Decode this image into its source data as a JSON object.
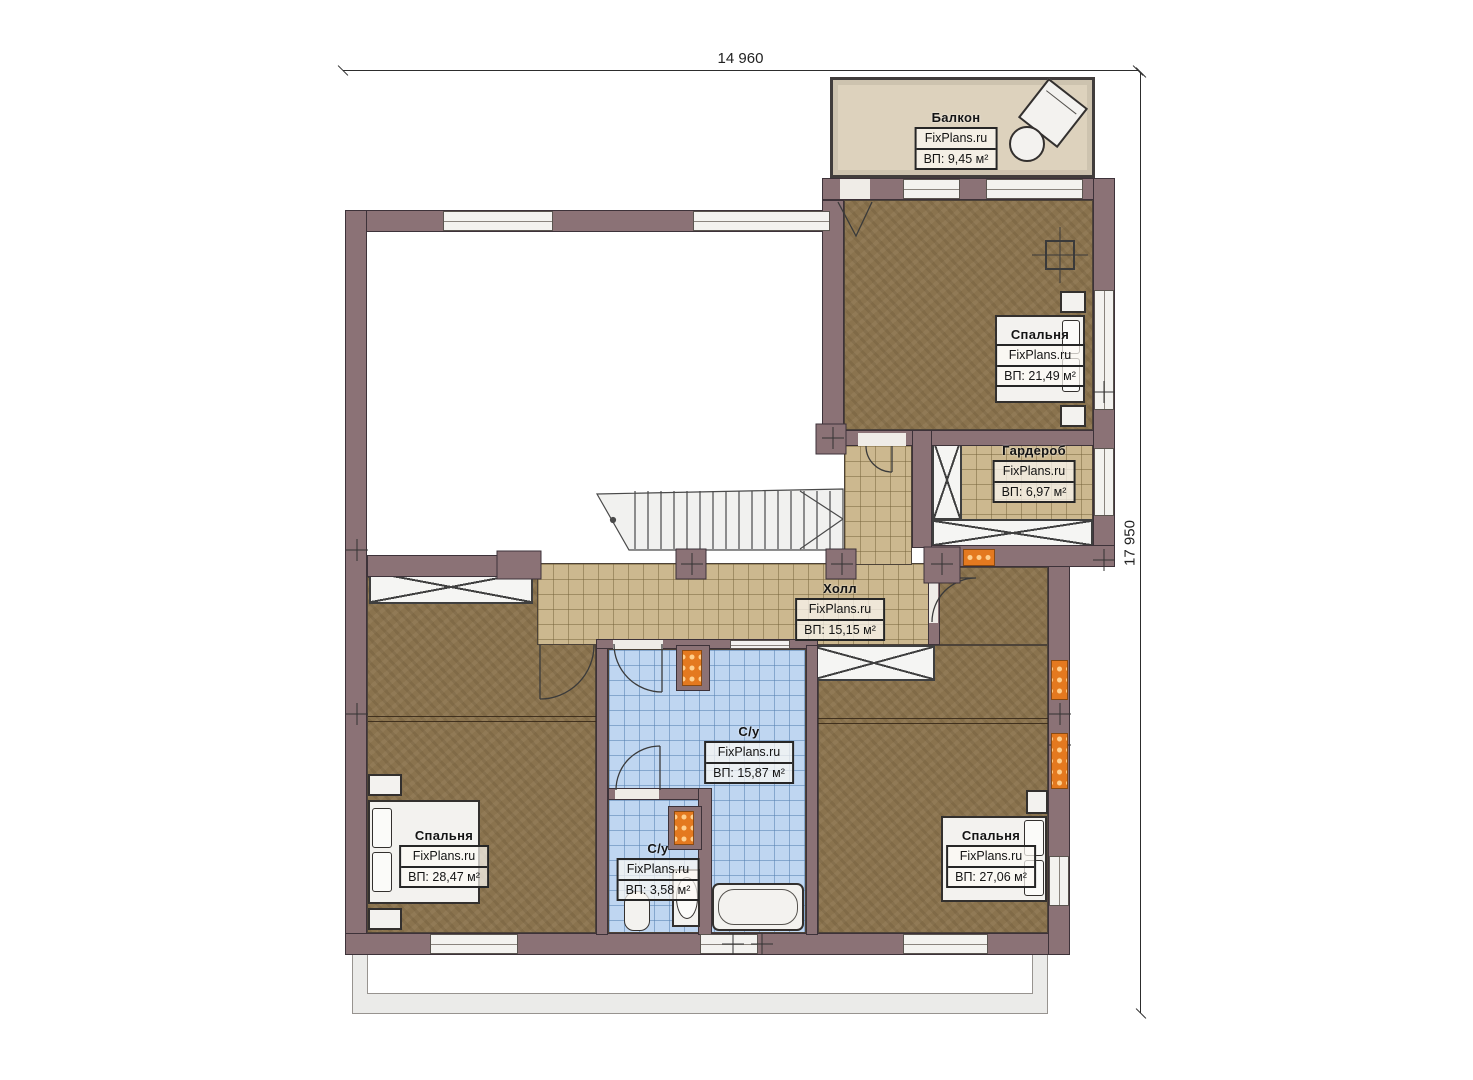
{
  "dimensions": {
    "top": "14 960",
    "right": "17 950"
  },
  "rooms": {
    "balcony": {
      "name": "Балкон",
      "brand": "FixPlans.ru",
      "area": "ВП: 9,45 м²"
    },
    "bedroom_tr": {
      "name": "Спальня",
      "brand": "FixPlans.ru",
      "area": "ВП: 21,49 м²"
    },
    "wardrobe": {
      "name": "Гардероб",
      "brand": "FixPlans.ru",
      "area": "ВП: 6,97 м²"
    },
    "hall": {
      "name": "Холл",
      "brand": "FixPlans.ru",
      "area": "ВП: 15,15 м²"
    },
    "bathroom_main": {
      "name": "С/у",
      "brand": "FixPlans.ru",
      "area": "ВП: 15,87 м²"
    },
    "bathroom_small": {
      "name": "С/у",
      "brand": "FixPlans.ru",
      "area": "ВП: 3,58 м²"
    },
    "bedroom_bl": {
      "name": "Спальня",
      "brand": "FixPlans.ru",
      "area": "ВП: 28,47 м²"
    },
    "bedroom_br": {
      "name": "Спальня",
      "brand": "FixPlans.ru",
      "area": "ВП: 27,06 м²"
    }
  },
  "colors": {
    "wall": "#8b7276",
    "wood_floor": "#8a734e",
    "hall_tile": "#ccb88f",
    "bath_tile": "#bfd6f1",
    "balcony_floor": "#ddd2bd",
    "radiator": "#e4791f"
  }
}
